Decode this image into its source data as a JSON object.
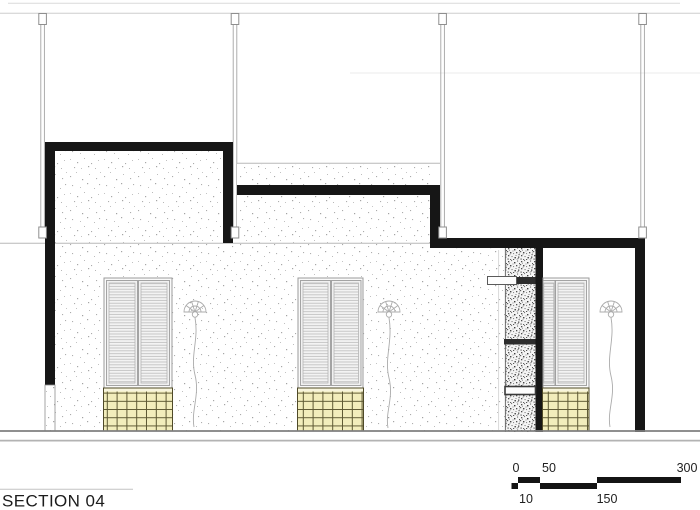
{
  "title": {
    "label": "SECTION 04"
  },
  "scale_bar": {
    "labels_top": [
      "0",
      "50",
      "300"
    ],
    "labels_bottom": [
      "10",
      "150"
    ]
  },
  "colors": {
    "ink": "#161616",
    "stipple_dot": "#ababab",
    "hatch_dot": "#4f4f4f",
    "tile_fill": "#f2edbc",
    "tile_grid": "#55502c",
    "frame_gray": "#9b9b9b",
    "ground_line": "#7f7f7f",
    "level_line": "#cdcdcd"
  }
}
